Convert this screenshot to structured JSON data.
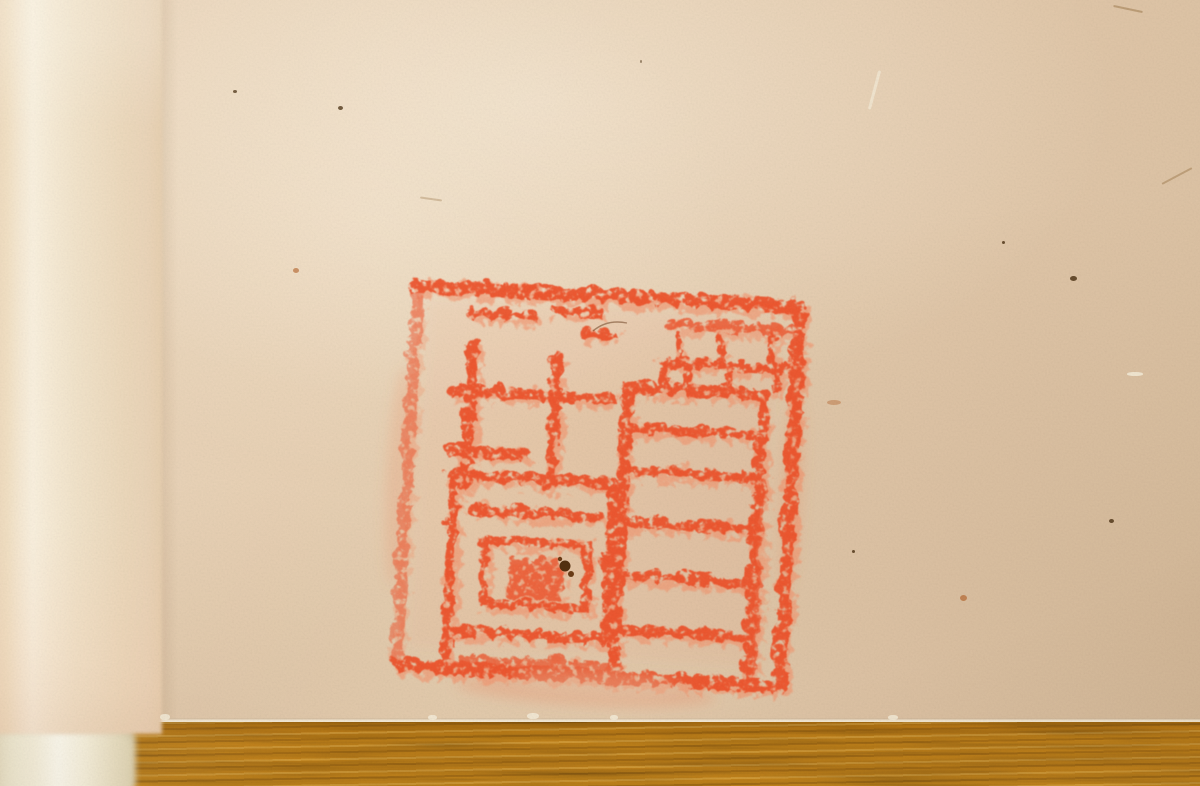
{
  "scene": {
    "description": "Close-up photograph of a handscroll detail: a large square red seal impression stamped on aged tan paper, with the soft-focus rolled end of the scroll and an ivory roller knob at the left edge, resting on an amber wood table",
    "medium": "photograph",
    "objects": [
      {
        "name": "scroll-paper",
        "appearance": "aged tan paper with tiny flecks and fibers"
      },
      {
        "name": "seal-impression",
        "appearance": "square red ink seal, mottled impression, seal-script characters arranged in a 2x2 grid inside a thick border"
      },
      {
        "name": "rolled-scroll-edge",
        "appearance": "vertical rolled paper edge with a bright sheen, out of focus"
      },
      {
        "name": "roller-knob",
        "appearance": "ivory colored end knob of the scroll roller, blurred, bottom left"
      },
      {
        "name": "table-surface",
        "appearance": "amber wood tabletop with horizontal grain along the bottom edge"
      }
    ]
  },
  "colors": {
    "paper": "#e4cbad",
    "paper_light": "#f4e6cc",
    "paper_dark": "#dcc2a3",
    "roll": "#f1e2c8",
    "roll_highlight": "#f9f0de",
    "roll_shadow": "#e9d2b5",
    "knob": "#f4eeda",
    "knob_bright": "#fcf9ee",
    "knob_shadow": "#e0d6b8",
    "wood": "#c8861a",
    "wood_dark": "#8f5c0c",
    "wood_light": "#e2a83c",
    "seal_red": "#ee5129",
    "seal_red_light": "#f4936c",
    "seal_halo": "#f0855c",
    "speck_dark": "#4a2f12",
    "speck_rust": "#b4622a",
    "fiber": "#9a7648",
    "scuff": "#f5ecd8",
    "blotch_brown": "#53300f"
  },
  "features": [
    {
      "type": "dark",
      "x": 233,
      "y": 90,
      "w": 4,
      "h": 3
    },
    {
      "type": "dark",
      "x": 338,
      "y": 106,
      "w": 5,
      "h": 4
    },
    {
      "type": "rust",
      "x": 293,
      "y": 268,
      "w": 6,
      "h": 5
    },
    {
      "type": "dark",
      "x": 1070,
      "y": 276,
      "w": 7,
      "h": 5
    },
    {
      "type": "dark",
      "x": 1002,
      "y": 241,
      "w": 3,
      "h": 3
    },
    {
      "type": "dark",
      "x": 1109,
      "y": 519,
      "w": 5,
      "h": 4
    },
    {
      "type": "dark",
      "x": 852,
      "y": 550,
      "w": 3,
      "h": 3
    },
    {
      "type": "rust",
      "x": 960,
      "y": 595,
      "w": 7,
      "h": 6
    },
    {
      "type": "rust",
      "x": 827,
      "y": 400,
      "w": 14,
      "h": 5,
      "opacity": 0.4
    },
    {
      "type": "scuff",
      "x": 1127,
      "y": 372,
      "w": 16,
      "h": 4
    },
    {
      "type": "dark",
      "x": 640,
      "y": 60,
      "w": 2,
      "h": 3,
      "opacity": 0.5
    },
    {
      "type": "fiber-light",
      "x": 873,
      "y": 70,
      "w": 3,
      "h": 40,
      "rot": 15
    },
    {
      "type": "fiber-dark",
      "x": 1113,
      "y": 8,
      "w": 30,
      "h": 2,
      "rot": 12,
      "opacity": 0.5
    },
    {
      "type": "fiber-dark",
      "x": 1160,
      "y": 175,
      "w": 34,
      "h": 2,
      "rot": -28,
      "opacity": 0.45
    },
    {
      "type": "fiber-dark",
      "x": 420,
      "y": 198,
      "w": 22,
      "h": 2,
      "rot": 8,
      "opacity": 0.35
    },
    {
      "type": "scuff",
      "x": 160,
      "y": 714,
      "w": 10,
      "h": 6
    },
    {
      "type": "scuff",
      "x": 428,
      "y": 715,
      "w": 9,
      "h": 5
    },
    {
      "type": "scuff",
      "x": 527,
      "y": 713,
      "w": 12,
      "h": 6
    },
    {
      "type": "scuff",
      "x": 610,
      "y": 715,
      "w": 8,
      "h": 5
    },
    {
      "type": "scuff",
      "x": 888,
      "y": 715,
      "w": 10,
      "h": 5
    }
  ]
}
